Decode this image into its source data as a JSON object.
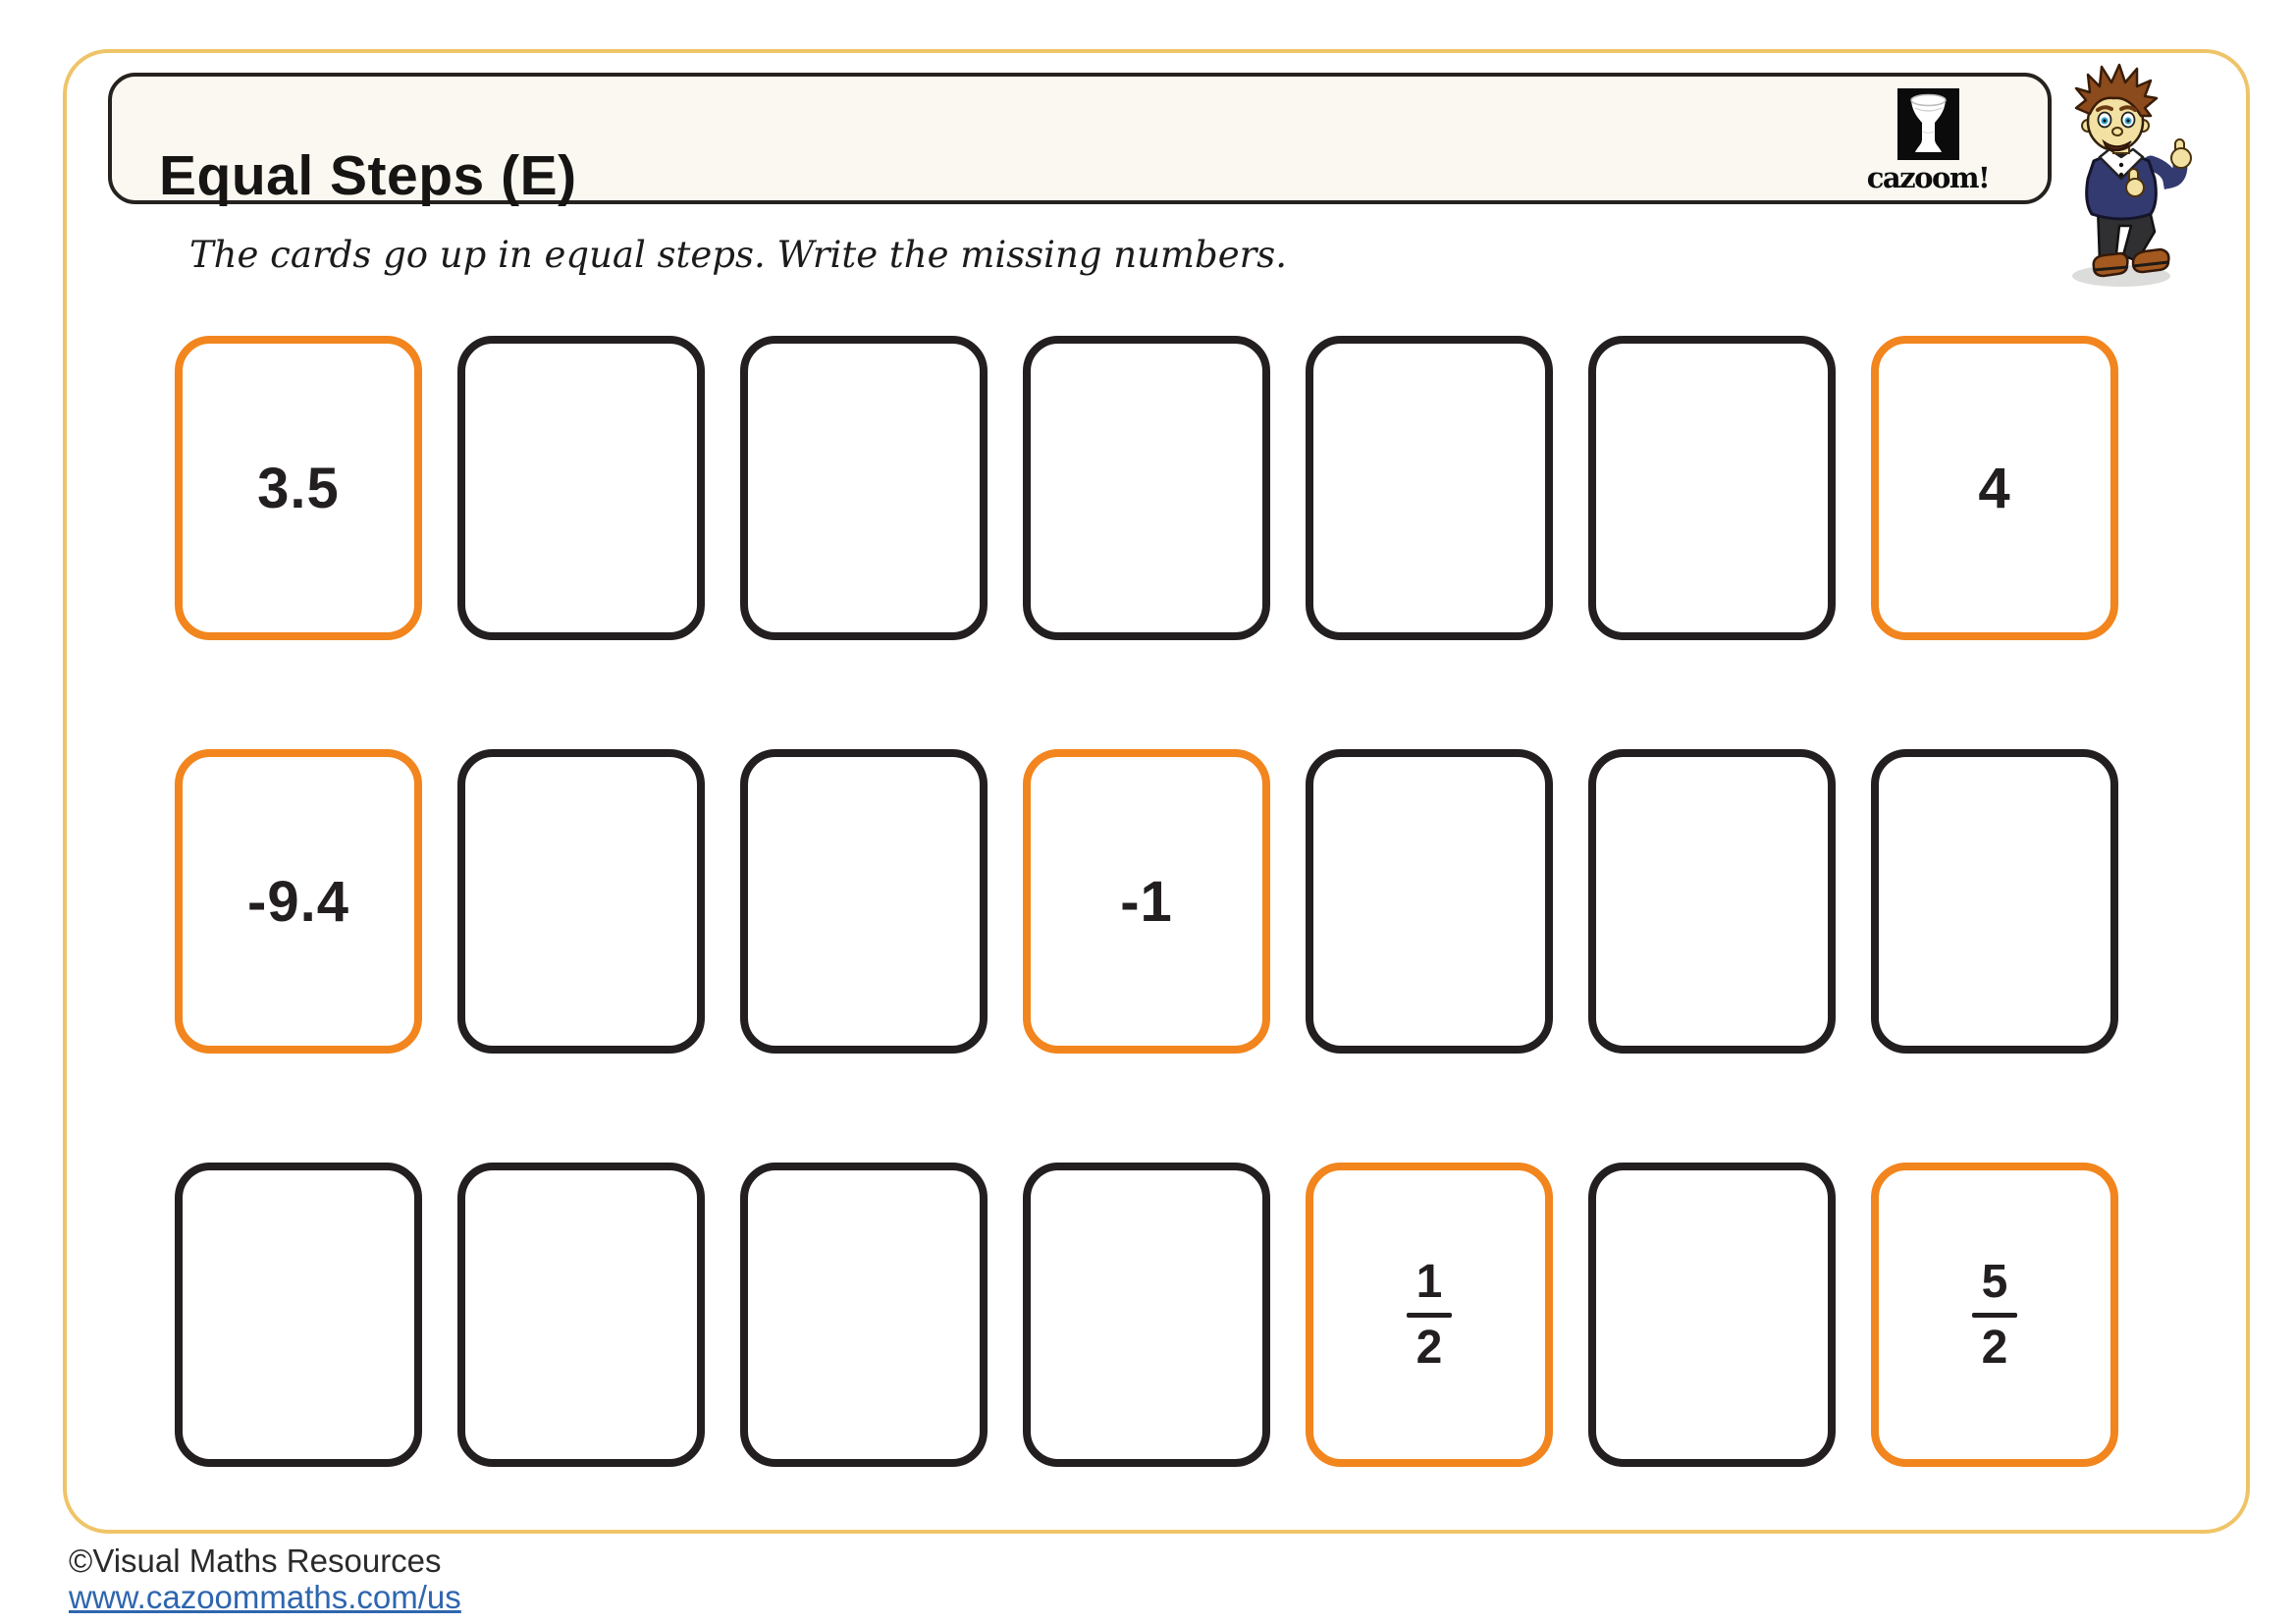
{
  "header": {
    "title": "Equal Steps (E)",
    "instruction": "The cards go up in equal steps. Write the missing numbers.",
    "logo_text": "cazoom!"
  },
  "rows": [
    {
      "cards": [
        {
          "state": "given",
          "value": "3.5"
        },
        {
          "state": "blank"
        },
        {
          "state": "blank"
        },
        {
          "state": "blank"
        },
        {
          "state": "blank"
        },
        {
          "state": "blank"
        },
        {
          "state": "given",
          "value": "4"
        }
      ]
    },
    {
      "cards": [
        {
          "state": "given",
          "value": "-9.4"
        },
        {
          "state": "blank"
        },
        {
          "state": "blank"
        },
        {
          "state": "given",
          "value": "-1"
        },
        {
          "state": "blank"
        },
        {
          "state": "blank"
        },
        {
          "state": "blank"
        }
      ]
    },
    {
      "cards": [
        {
          "state": "blank"
        },
        {
          "state": "blank"
        },
        {
          "state": "blank"
        },
        {
          "state": "blank"
        },
        {
          "state": "given",
          "fraction": {
            "numerator": "1",
            "denominator": "2"
          }
        },
        {
          "state": "blank"
        },
        {
          "state": "given",
          "fraction": {
            "numerator": "5",
            "denominator": "2"
          }
        }
      ]
    }
  ],
  "footer": {
    "copyright": "©Visual Maths Resources",
    "url": "www.cazoommaths.com/us"
  },
  "colors": {
    "accent_orange": "#F2851D",
    "card_dark": "#231F20",
    "border_yellow": "#EFC468",
    "title_bg": "#FAF8F0",
    "link_blue": "#2E66AE"
  }
}
